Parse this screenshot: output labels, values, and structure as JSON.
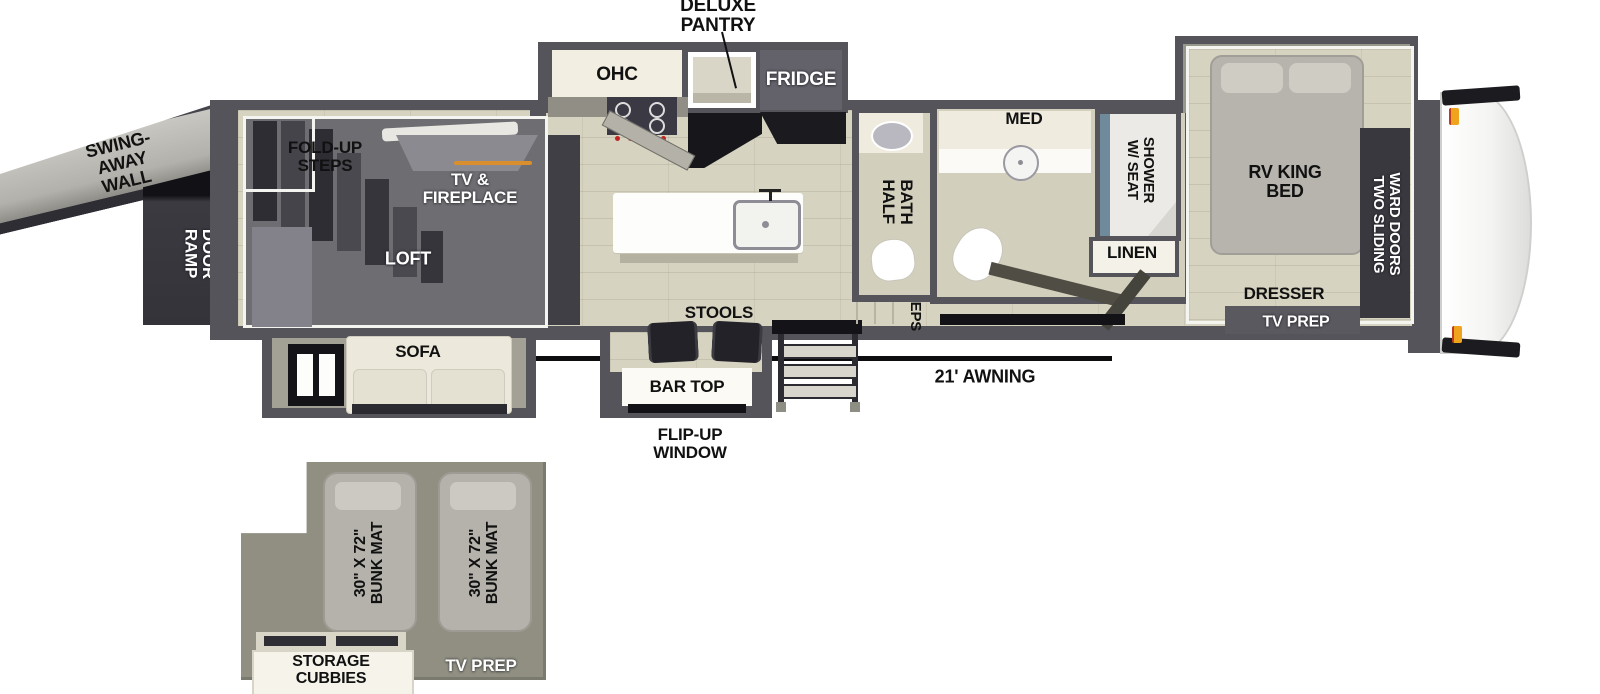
{
  "meta": {
    "type": "rv-floorplan-diagram"
  },
  "colors": {
    "wall": "#55545b",
    "floor": "#d7d3c1",
    "loft": "#6e6d71",
    "inset_bg": "#908f82",
    "accent_orange": "#f0a41e",
    "shower_glass": "#6f8b9b",
    "counter_cream": "#f2efe2",
    "label_black": "#111111",
    "label_white": "#ffffff"
  },
  "labels": {
    "deluxe_pantry": "DELUXE\nPANTRY",
    "ohc": "OHC",
    "fridge": "FRIDGE",
    "swing_away_wall": "SWING-AWAY\nWALL",
    "ramp_door": "RAMP\nDOOR",
    "fold_up_steps": "FOLD-UP\nSTEPS",
    "tv_fireplace": "TV &\nFIREPLACE",
    "loft": "LOFT",
    "sofa": "SOFA",
    "stools": "STOOLS",
    "bar_top": "BAR TOP",
    "flip_up_window": "FLIP-UP\nWINDOW",
    "awning": "21' AWNING",
    "steps": "STEPS",
    "half_bath": "HALF\nBATH",
    "med": "MED",
    "shower_w_seat": "SHOWER\nW/ SEAT",
    "linen": "LINEN",
    "rv_king_bed": "RV KING\nBED",
    "ward_doors": "TWO SLIDING\nWARD DOORS",
    "dresser": "DRESSER",
    "tv_prep": "TV PREP",
    "bunk_mat": "30\" X 72\"\nBUNK MAT",
    "storage_cubbies": "STORAGE\nCUBBIES"
  }
}
